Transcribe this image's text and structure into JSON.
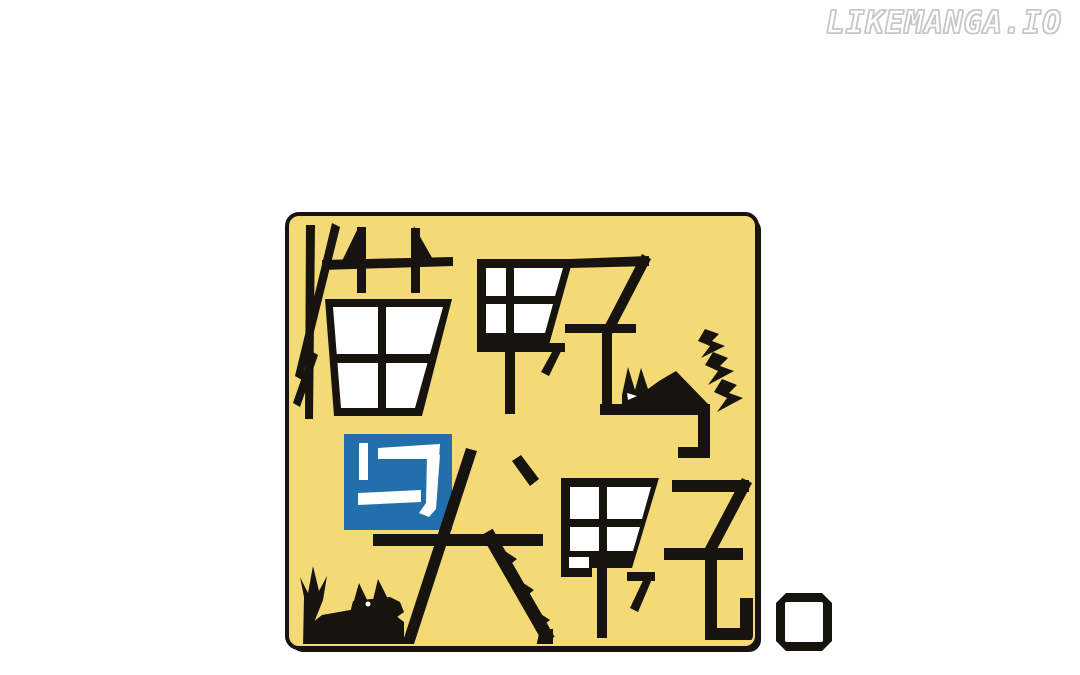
{
  "site": {
    "logo_text": "LIKEMANGA.IO"
  },
  "cover": {
    "title": "猫野与犬野。",
    "characters": {
      "top": "猫野",
      "connector": "与",
      "bottom": "犬野",
      "period": "。"
    },
    "icons": {
      "cat": "cat-silhouette",
      "dog": "dog-silhouette",
      "sparks": "lightning-sparks",
      "period": "square-period"
    },
    "colors": {
      "background": "#f3da76",
      "ink": "#17130f",
      "connector_blue": "#2170ab",
      "panel_white": "#ffffff"
    }
  }
}
